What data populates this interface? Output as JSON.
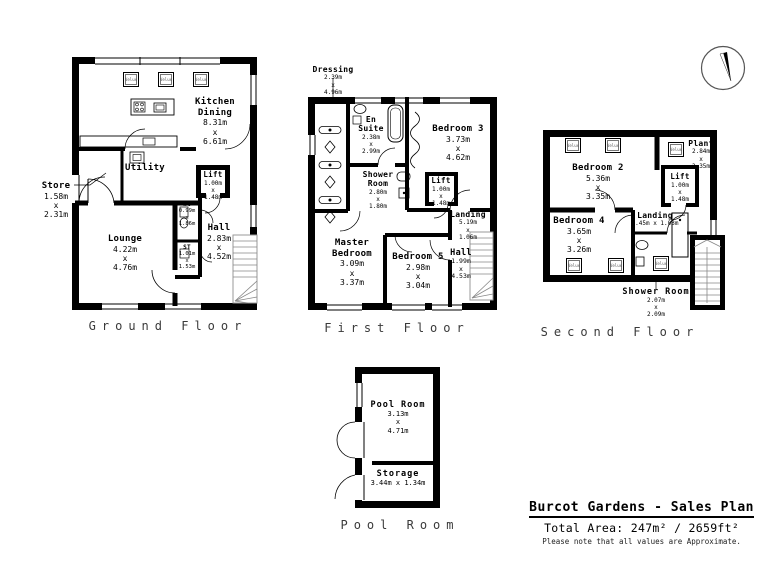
{
  "page": {
    "title": "Burcot Gardens - Sales Plan",
    "total_area": "Total Area: 247m² / 2659ft²",
    "disclaimer": "Please note that all values are Approximate."
  },
  "labels": {
    "velux": "Velux"
  },
  "floors": [
    {
      "label": "Ground Floor",
      "rooms": [
        {
          "name": "Kitchen Dining",
          "d": [
            "8.31m",
            "x",
            "6.61m"
          ]
        },
        {
          "name": "Utility",
          "d": []
        },
        {
          "name": "Lift",
          "d": [
            "1.00m",
            "x",
            "1.48m"
          ]
        },
        {
          "name": "Store",
          "d": [
            "1.58m",
            "x",
            "2.31m"
          ]
        },
        {
          "name": "WC",
          "d": [
            "0.99m",
            "x",
            "1.86m"
          ]
        },
        {
          "name": "ST",
          "d": [
            "1.01m",
            "x",
            "1.53m"
          ]
        },
        {
          "name": "Hall",
          "d": [
            "2.83m",
            "x",
            "4.52m"
          ]
        },
        {
          "name": "Lounge",
          "d": [
            "4.22m",
            "x",
            "4.76m"
          ]
        }
      ]
    },
    {
      "label": "First Floor",
      "rooms": [
        {
          "name": "Dressing",
          "d": [
            "2.39m",
            "x",
            "4.96m"
          ]
        },
        {
          "name": "En Suite",
          "d": [
            "2.38m",
            "x",
            "2.99m"
          ]
        },
        {
          "name": "Bedroom 3",
          "d": [
            "3.73m",
            "x",
            "4.62m"
          ]
        },
        {
          "name": "Shower Room",
          "d": [
            "2.80m",
            "x",
            "1.80m"
          ]
        },
        {
          "name": "Lift",
          "d": [
            "1.00m",
            "x",
            "1.48m"
          ]
        },
        {
          "name": "Landing",
          "d": [
            "5.19m",
            "x",
            "1.06m"
          ]
        },
        {
          "name": "Master Bedroom",
          "d": [
            "3.09m",
            "x",
            "3.37m"
          ]
        },
        {
          "name": "Bedroom 5",
          "d": [
            "2.98m",
            "x",
            "3.04m"
          ]
        },
        {
          "name": "Hall",
          "d": [
            "1.99m",
            "x",
            "4.53m"
          ]
        }
      ]
    },
    {
      "label": "Second Floor",
      "rooms": [
        {
          "name": "Bedroom 2",
          "d": [
            "5.36m",
            "x",
            "3.35m"
          ]
        },
        {
          "name": "Plant",
          "d": [
            "2.84m",
            "x",
            "3.35m"
          ]
        },
        {
          "name": "Lift",
          "d": [
            "1.00m",
            "x",
            "1.48m"
          ]
        },
        {
          "name": "Landing",
          "d": [
            "4.45m x 1.03m"
          ]
        },
        {
          "name": "Bedroom 4",
          "d": [
            "3.65m",
            "x",
            "3.26m"
          ]
        },
        {
          "name": "Shower Room",
          "d": [
            "2.07m",
            "x",
            "2.09m"
          ]
        }
      ]
    },
    {
      "label": "Pool Room",
      "rooms": [
        {
          "name": "Pool Room",
          "d": [
            "3.13m",
            "x",
            "4.71m"
          ]
        },
        {
          "name": "Storage",
          "d": [
            "3.44m x 1.34m"
          ]
        }
      ]
    }
  ]
}
